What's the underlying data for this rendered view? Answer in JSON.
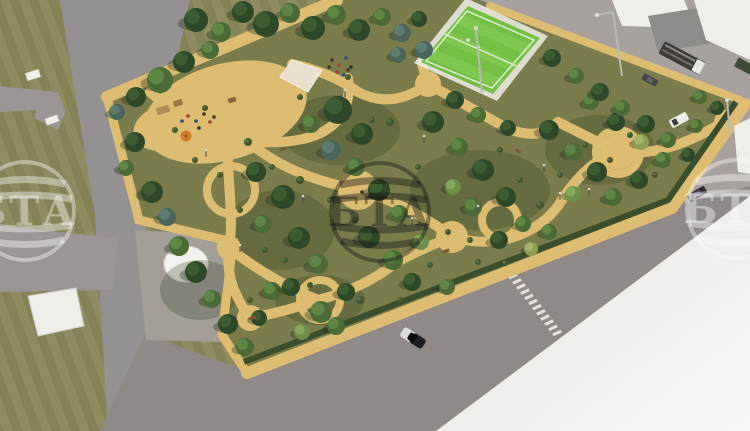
{
  "scene": {
    "description": "Aerial 3D architectural rendering of a planned city park: tree-filled block with winding sand paths, playground, pale court, green sports field, surrounding gray streets, white buildings top-right, plaza with white dome bottom-left, blank white lot bottom-right."
  },
  "palette": {
    "grass_outer": "#8e8c60",
    "grass_outer_stripe": "#848256",
    "grass_park": "#7b7c4c",
    "sand": "#dcbd72",
    "sand_light": "#e6cc84",
    "road": "#959092",
    "road_bottom": "#8f8a88",
    "road_ne": "#a7a29e",
    "road_branch": "#9b9695",
    "plaza": "#a49e99",
    "white_zone_near": "#e9e6e2",
    "white_zone_far": "#f8f6f3",
    "building_white": "#f0eee9",
    "building_gray": "#8e8c89",
    "building_gray_dark": "#757370",
    "field_apron": "#d4d6c7",
    "field_green": "#74c044",
    "field_green_light": "#8ad058",
    "field_line": "#eef7e6",
    "hedge": "#3a4e2c",
    "dome": "#f4f2ee",
    "court": "#e9e1cd",
    "umbrella": "#d07b2a",
    "wm_light": "rgba(255,255,255,0.40)",
    "wm_dark": "rgba(20,22,20,0.42)"
  },
  "watermark": {
    "text": "БТА",
    "left_visible": "ТА",
    "center_visible": "БТА",
    "right_visible": "БТ"
  },
  "trees": [
    [
      196,
      20,
      12,
      "d"
    ],
    [
      221,
      32,
      10,
      "m"
    ],
    [
      243,
      12,
      11,
      "d"
    ],
    [
      266,
      24,
      13,
      "d"
    ],
    [
      290,
      13,
      10,
      "m"
    ],
    [
      313,
      28,
      12,
      "d"
    ],
    [
      336,
      15,
      10,
      "m"
    ],
    [
      359,
      30,
      11,
      "d"
    ],
    [
      382,
      17,
      9,
      "m"
    ],
    [
      402,
      33,
      9,
      "s"
    ],
    [
      419,
      19,
      8,
      "d"
    ],
    [
      424,
      50,
      9,
      "s"
    ],
    [
      398,
      55,
      8,
      "s"
    ],
    [
      160,
      80,
      13,
      "m"
    ],
    [
      136,
      97,
      10,
      "d"
    ],
    [
      184,
      62,
      11,
      "d"
    ],
    [
      210,
      50,
      9,
      "m"
    ],
    [
      117,
      112,
      8,
      "s"
    ],
    [
      135,
      142,
      10,
      "d"
    ],
    [
      126,
      168,
      8,
      "m"
    ],
    [
      152,
      192,
      11,
      "d"
    ],
    [
      167,
      217,
      9,
      "s"
    ],
    [
      179,
      246,
      10,
      "m"
    ],
    [
      196,
      272,
      11,
      "d"
    ],
    [
      212,
      299,
      9,
      "m"
    ],
    [
      228,
      324,
      10,
      "d"
    ],
    [
      245,
      347,
      9,
      "m"
    ],
    [
      259,
      318,
      8,
      "d"
    ],
    [
      272,
      291,
      9,
      "m"
    ],
    [
      256,
      172,
      10,
      "d"
    ],
    [
      283,
      197,
      12,
      "d"
    ],
    [
      263,
      224,
      9,
      "m"
    ],
    [
      299,
      238,
      11,
      "d"
    ],
    [
      318,
      264,
      10,
      "m"
    ],
    [
      291,
      287,
      9,
      "d"
    ],
    [
      321,
      312,
      11,
      "m"
    ],
    [
      346,
      292,
      9,
      "d"
    ],
    [
      302,
      332,
      8,
      "l"
    ],
    [
      336,
      326,
      9,
      "m"
    ],
    [
      338,
      110,
      14,
      "d"
    ],
    [
      362,
      134,
      11,
      "d"
    ],
    [
      331,
      150,
      10,
      "s"
    ],
    [
      311,
      124,
      9,
      "m"
    ],
    [
      356,
      167,
      9,
      "m"
    ],
    [
      379,
      190,
      11,
      "d"
    ],
    [
      399,
      214,
      9,
      "m"
    ],
    [
      369,
      237,
      11,
      "d"
    ],
    [
      393,
      260,
      10,
      "m"
    ],
    [
      421,
      242,
      8,
      "l"
    ],
    [
      412,
      282,
      9,
      "d"
    ],
    [
      447,
      287,
      8,
      "m"
    ],
    [
      433,
      122,
      11,
      "d"
    ],
    [
      459,
      147,
      9,
      "m"
    ],
    [
      483,
      170,
      11,
      "d"
    ],
    [
      453,
      187,
      8,
      "l"
    ],
    [
      473,
      207,
      9,
      "m"
    ],
    [
      506,
      197,
      10,
      "d"
    ],
    [
      523,
      224,
      8,
      "m"
    ],
    [
      499,
      240,
      9,
      "d"
    ],
    [
      531,
      249,
      7,
      "y"
    ],
    [
      549,
      232,
      8,
      "m"
    ],
    [
      549,
      130,
      10,
      "d"
    ],
    [
      573,
      152,
      9,
      "m"
    ],
    [
      597,
      172,
      10,
      "d"
    ],
    [
      573,
      194,
      8,
      "l"
    ],
    [
      613,
      197,
      9,
      "m"
    ],
    [
      639,
      180,
      9,
      "d"
    ],
    [
      663,
      160,
      8,
      "m"
    ],
    [
      641,
      142,
      8,
      "y"
    ],
    [
      616,
      122,
      9,
      "d"
    ],
    [
      591,
      102,
      8,
      "m"
    ],
    [
      552,
      58,
      9,
      "d"
    ],
    [
      576,
      76,
      8,
      "m"
    ],
    [
      600,
      92,
      9,
      "d"
    ],
    [
      622,
      108,
      8,
      "m"
    ],
    [
      646,
      124,
      9,
      "d"
    ],
    [
      668,
      140,
      8,
      "m"
    ],
    [
      688,
      155,
      7,
      "d"
    ],
    [
      700,
      97,
      7,
      "m"
    ],
    [
      717,
      108,
      7,
      "d"
    ],
    [
      696,
      126,
      7,
      "m"
    ],
    [
      455,
      100,
      9,
      "d"
    ],
    [
      478,
      115,
      8,
      "m"
    ],
    [
      508,
      128,
      8,
      "d"
    ]
  ],
  "shrubs": [
    [
      175,
      130,
      3
    ],
    [
      205,
      108,
      3
    ],
    [
      248,
      142,
      4
    ],
    [
      272,
      167,
      3
    ],
    [
      300,
      97,
      3
    ],
    [
      348,
      77,
      3
    ],
    [
      390,
      122,
      4
    ],
    [
      418,
      167,
      3
    ],
    [
      448,
      232,
      3
    ],
    [
      478,
      262,
      3
    ],
    [
      505,
      263,
      3
    ],
    [
      540,
      205,
      4
    ],
    [
      560,
      175,
      3
    ],
    [
      585,
      145,
      3
    ],
    [
      610,
      160,
      3
    ],
    [
      330,
      200,
      3
    ],
    [
      355,
      220,
      3
    ],
    [
      300,
      180,
      4
    ],
    [
      265,
      250,
      3
    ],
    [
      240,
      210,
      3
    ],
    [
      285,
      260,
      3
    ],
    [
      310,
      285,
      3
    ],
    [
      360,
      300,
      4
    ],
    [
      400,
      300,
      3
    ],
    [
      430,
      265,
      3
    ],
    [
      520,
      180,
      3
    ],
    [
      470,
      240,
      3
    ],
    [
      195,
      160,
      3
    ],
    [
      220,
      175,
      3
    ],
    [
      250,
      300,
      3
    ],
    [
      372,
      120,
      3
    ],
    [
      500,
      150,
      3
    ],
    [
      630,
      135,
      3
    ],
    [
      655,
      175,
      3
    ]
  ],
  "people": [
    {
      "x": 188,
      "y": 116,
      "c": "#a6402e"
    },
    {
      "x": 196,
      "y": 121,
      "c": "#31517c"
    },
    {
      "x": 204,
      "y": 114,
      "c": "#4a3326"
    },
    {
      "x": 210,
      "y": 122,
      "c": "#a6402e"
    },
    {
      "x": 199,
      "y": 128,
      "c": "#2f2f2f"
    },
    {
      "x": 182,
      "y": 121,
      "c": "#31517c"
    },
    {
      "x": 214,
      "y": 117,
      "c": "#4a3326"
    },
    {
      "x": 332,
      "y": 60,
      "c": "#4a3326"
    },
    {
      "x": 339,
      "y": 65,
      "c": "#a6402e"
    },
    {
      "x": 346,
      "y": 58,
      "c": "#31517c"
    },
    {
      "x": 351,
      "y": 67,
      "c": "#2f2f2f"
    },
    {
      "x": 337,
      "y": 72,
      "c": "#a6402e"
    },
    {
      "x": 344,
      "y": 75,
      "c": "#31517c"
    },
    {
      "x": 329,
      "y": 67,
      "c": "#4a3326"
    },
    {
      "x": 348,
      "y": 70,
      "c": "#4a3326"
    },
    {
      "x": 362,
      "y": 192,
      "c": "#2f2f2f"
    },
    {
      "x": 370,
      "y": 196,
      "c": "#4a3326"
    },
    {
      "x": 468,
      "y": 40,
      "c": "#e8e8e8"
    },
    {
      "x": 478,
      "y": 47,
      "c": "#e8e8e8"
    }
  ],
  "play_structures": [
    {
      "x": 163,
      "y": 110,
      "w": 13,
      "h": 7,
      "rot": -18,
      "c": "#b08a54"
    },
    {
      "x": 178,
      "y": 103,
      "w": 9,
      "h": 6,
      "rot": -18,
      "c": "#9a7743"
    },
    {
      "x": 232,
      "y": 100,
      "w": 8,
      "h": 5,
      "rot": -18,
      "c": "#8a6a3e"
    }
  ],
  "umbrella": {
    "x": 186,
    "y": 136,
    "r": 5.5
  },
  "vehicles": [
    {
      "type": "truck",
      "x": 682,
      "y": 58,
      "rot": 28
    },
    {
      "type": "car-two-tone",
      "x": 413,
      "y": 338,
      "rot": 33
    },
    {
      "type": "car-dark",
      "x": 697,
      "y": 194,
      "rot": -30
    },
    {
      "type": "car-parked",
      "x": 650,
      "y": 80,
      "rot": 28
    },
    {
      "type": "van-white",
      "x": 679,
      "y": 120,
      "rot": -28
    },
    {
      "type": "box-dark",
      "x": 746,
      "y": 67,
      "rot": 28
    }
  ],
  "crosswalk": {
    "x1": 509,
    "y1": 271,
    "x2": 557,
    "y2": 333,
    "count": 13,
    "w": 9,
    "h": 3,
    "rot": -25
  },
  "lamps_major": [
    {
      "px": 622,
      "py": 76,
      "tx": 613,
      "ty": 12,
      "ax": 597,
      "ay": 15
    },
    {
      "px": 482,
      "py": 93,
      "tx": 476,
      "ty": 28
    },
    {
      "px": 730,
      "py": 133,
      "tx": 727,
      "ty": 100
    }
  ],
  "lamps_mini": [
    [
      345,
      97
    ],
    [
      303,
      203
    ],
    [
      424,
      143
    ],
    [
      478,
      213
    ],
    [
      544,
      172
    ],
    [
      240,
      252
    ],
    [
      206,
      157
    ],
    [
      589,
      196
    ],
    [
      412,
      225
    ],
    [
      560,
      200
    ]
  ],
  "benches_white": [
    {
      "x": 33,
      "y": 75,
      "w": 14,
      "h": 8,
      "rot": -18
    },
    {
      "x": 52,
      "y": 120,
      "w": 13,
      "h": 7,
      "rot": -20
    }
  ],
  "benches_park": [
    {
      "x": 252,
      "y": 318,
      "w": 7,
      "h": 3,
      "rot": -20
    },
    {
      "x": 446,
      "y": 251,
      "w": 7,
      "h": 3,
      "rot": -20
    },
    {
      "x": 518,
      "y": 151,
      "w": 6,
      "h": 3,
      "rot": 30
    },
    {
      "x": 283,
      "y": 149,
      "w": 7,
      "h": 3,
      "rot": -15
    }
  ]
}
